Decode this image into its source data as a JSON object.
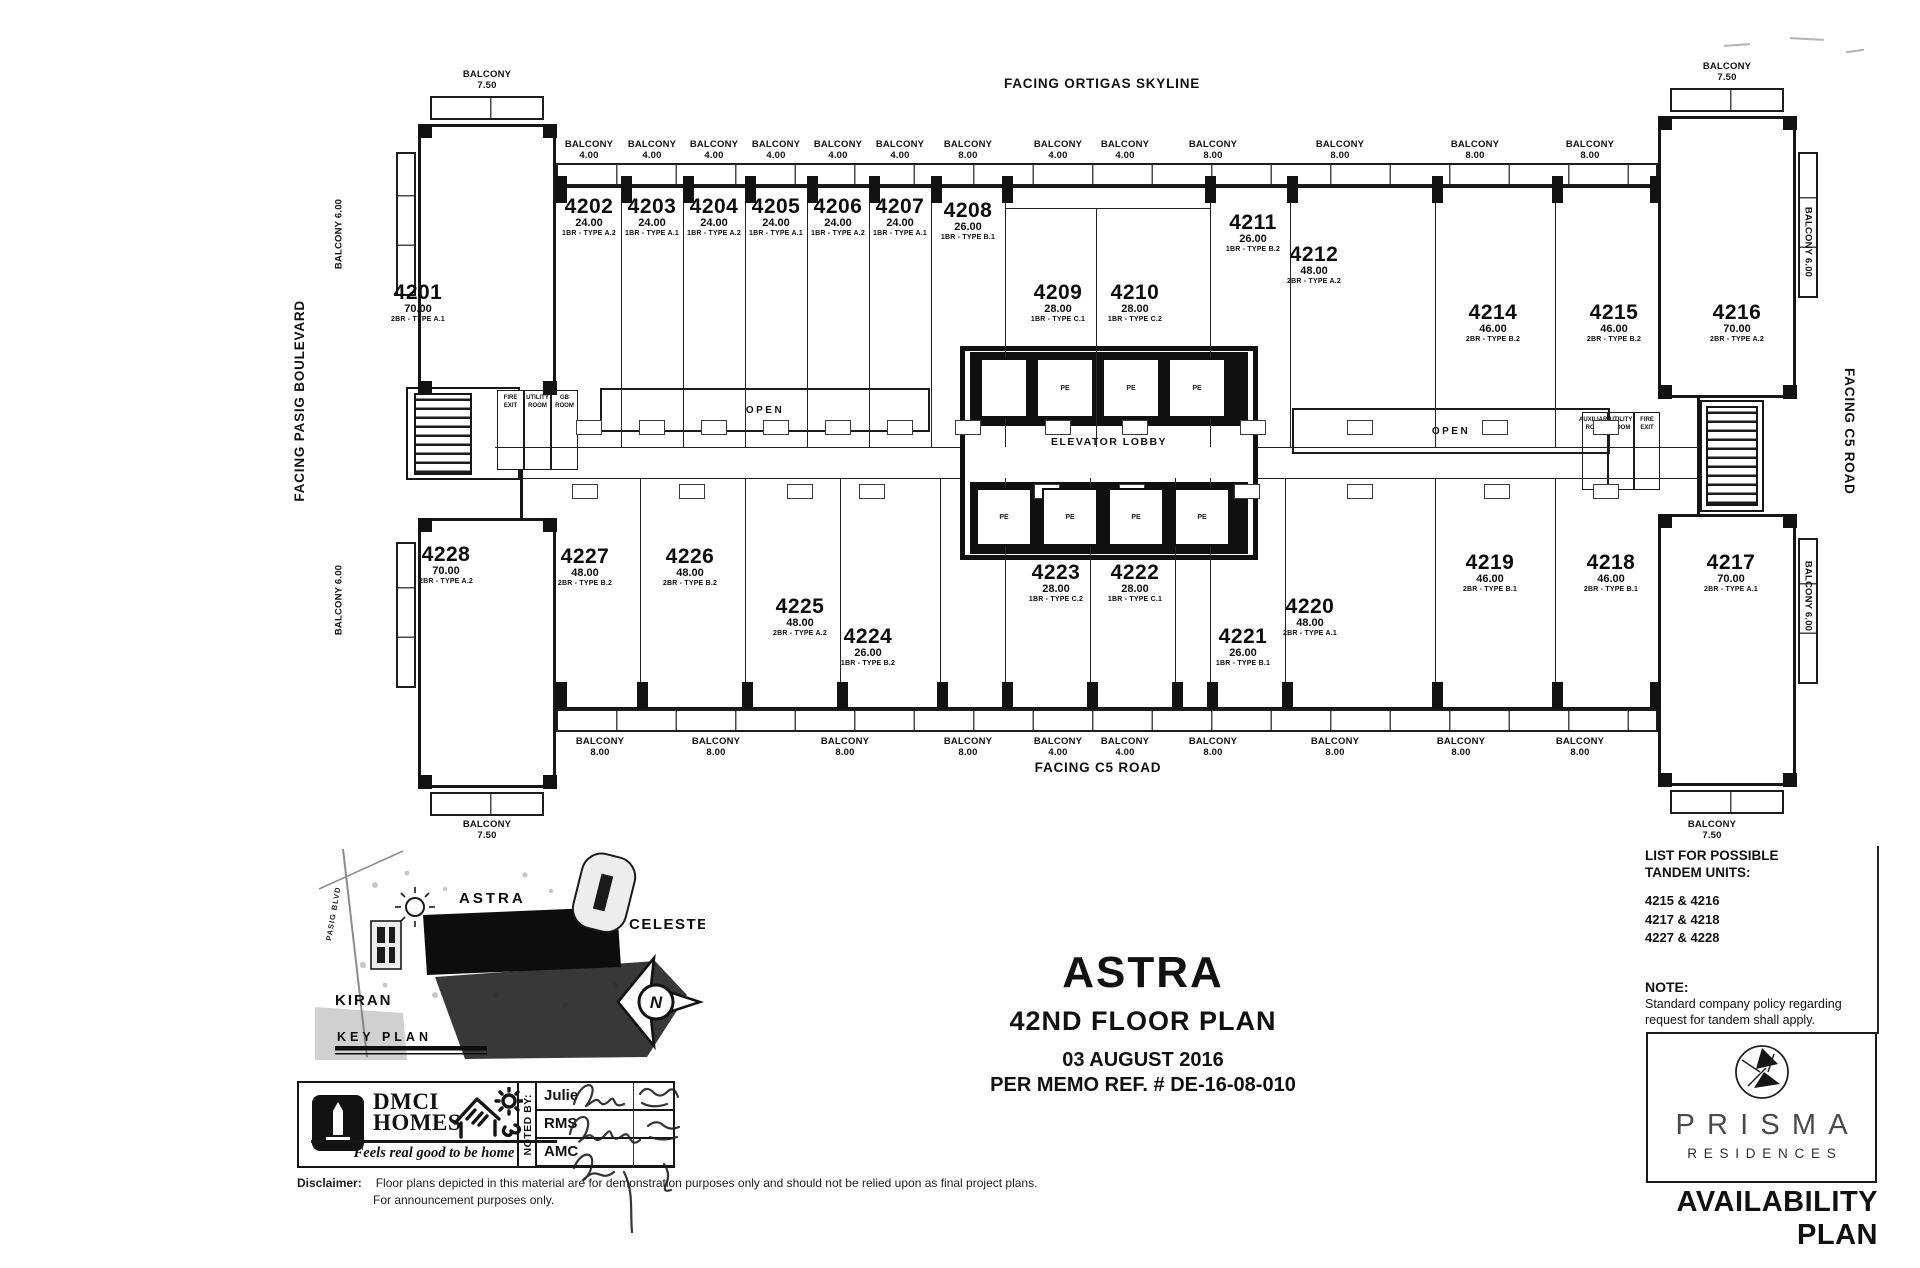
{
  "page": {
    "facing_top": "FACING ORTIGAS SKYLINE",
    "facing_left": "FACING PASIG BOULEVARD",
    "facing_right": "FACING C5 ROAD",
    "facing_bottom": "FACING C5 ROAD"
  },
  "plan": {
    "elevator_lobby": "ELEVATOR LOBBY",
    "elevator_car": "PE",
    "open": "OPEN",
    "left_rooms": [
      "FIRE EXIT",
      "UTILITY ROOM",
      "GB ROOM"
    ],
    "right_rooms": [
      "AUXILIARY ROOM",
      "UTILITY ROOM",
      "FIRE EXIT"
    ],
    "balcony_word": "BALCONY",
    "balconies_top": [
      "7.50",
      "4.00",
      "4.00",
      "4.00",
      "4.00",
      "4.00",
      "4.00",
      "8.00",
      "4.00",
      "4.00",
      "8.00",
      "8.00",
      "8.00",
      "8.00",
      "7.50"
    ],
    "balconies_bottom": [
      "7.50",
      "8.00",
      "8.00",
      "8.00",
      "8.00",
      "4.00",
      "4.00",
      "8.00",
      "8.00",
      "8.00",
      "8.00",
      "7.50"
    ],
    "balconies_left": [
      "6.00",
      "6.00"
    ],
    "balconies_right": [
      "6.00",
      "6.00"
    ],
    "units": [
      {
        "number": "4201",
        "area": "70.00",
        "type": "2BR - TYPE A.1"
      },
      {
        "number": "4202",
        "area": "24.00",
        "type": "1BR - TYPE A.2"
      },
      {
        "number": "4203",
        "area": "24.00",
        "type": "1BR - TYPE A.1"
      },
      {
        "number": "4204",
        "area": "24.00",
        "type": "1BR - TYPE A.2"
      },
      {
        "number": "4205",
        "area": "24.00",
        "type": "1BR - TYPE A.1"
      },
      {
        "number": "4206",
        "area": "24.00",
        "type": "1BR - TYPE A.2"
      },
      {
        "number": "4207",
        "area": "24.00",
        "type": "1BR - TYPE A.1"
      },
      {
        "number": "4208",
        "area": "26.00",
        "type": "1BR - TYPE B.1"
      },
      {
        "number": "4209",
        "area": "28.00",
        "type": "1BR - TYPE C.1"
      },
      {
        "number": "4210",
        "area": "28.00",
        "type": "1BR - TYPE C.2"
      },
      {
        "number": "4211",
        "area": "26.00",
        "type": "1BR - TYPE B.2"
      },
      {
        "number": "4212",
        "area": "48.00",
        "type": "2BR - TYPE A.2"
      },
      {
        "number": "4214",
        "area": "46.00",
        "type": "2BR - TYPE B.2"
      },
      {
        "number": "4215",
        "area": "46.00",
        "type": "2BR - TYPE B.2"
      },
      {
        "number": "4216",
        "area": "70.00",
        "type": "2BR - TYPE A.2"
      },
      {
        "number": "4217",
        "area": "70.00",
        "type": "2BR - TYPE A.1"
      },
      {
        "number": "4218",
        "area": "46.00",
        "type": "2BR - TYPE B.1"
      },
      {
        "number": "4219",
        "area": "46.00",
        "type": "2BR - TYPE B.1"
      },
      {
        "number": "4220",
        "area": "48.00",
        "type": "2BR - TYPE A.1"
      },
      {
        "number": "4221",
        "area": "26.00",
        "type": "1BR - TYPE B.1"
      },
      {
        "number": "4222",
        "area": "28.00",
        "type": "1BR - TYPE C.1"
      },
      {
        "number": "4223",
        "area": "28.00",
        "type": "1BR - TYPE C.2"
      },
      {
        "number": "4224",
        "area": "26.00",
        "type": "1BR - TYPE B.2"
      },
      {
        "number": "4225",
        "area": "48.00",
        "type": "2BR - TYPE A.2"
      },
      {
        "number": "4226",
        "area": "48.00",
        "type": "2BR - TYPE B.2"
      },
      {
        "number": "4227",
        "area": "48.00",
        "type": "2BR - TYPE B.2"
      },
      {
        "number": "4228",
        "area": "70.00",
        "type": "2BR - TYPE A.2"
      }
    ]
  },
  "key_plan": {
    "title": "KEY PLAN",
    "astra": "ASTRA",
    "celeste": "CELESTE",
    "kiran": "KIRAN",
    "road": "PASIG BLVD",
    "north": "N"
  },
  "title_block": {
    "project": "ASTRA",
    "floor": "42ND FLOOR PLAN",
    "date": "03 AUGUST 2016",
    "memo": "PER MEMO REF. # DE-16-08-010"
  },
  "tandem": {
    "heading1": "LIST FOR POSSIBLE",
    "heading2": "TANDEM UNITS:",
    "pairs": [
      "4215 & 4216",
      "4217 & 4218",
      "4227 & 4228"
    ],
    "note_label": "NOTE:",
    "note1": "Standard company policy regarding",
    "note2": "request for tandem shall apply."
  },
  "noted_by": {
    "label": "NOTED BY:",
    "rows": [
      "Julie",
      "RMS",
      "AMC"
    ]
  },
  "branding": {
    "dmci1": "DMCI",
    "dmci2": "HOMES",
    "tagline": "Feels real good to be home",
    "prisma": "PRISMA",
    "residences": "RESIDENCES",
    "availability": "AVAILABILITY PLAN"
  },
  "disclaimer": {
    "label": "Disclaimer:",
    "line1": "Floor plans depicted in this material are for demonstration purposes only and should not be relied upon as final project plans.",
    "line2": "For announcement purposes only."
  },
  "colors": {
    "ink": "#161616",
    "paper": "#ffffff"
  }
}
